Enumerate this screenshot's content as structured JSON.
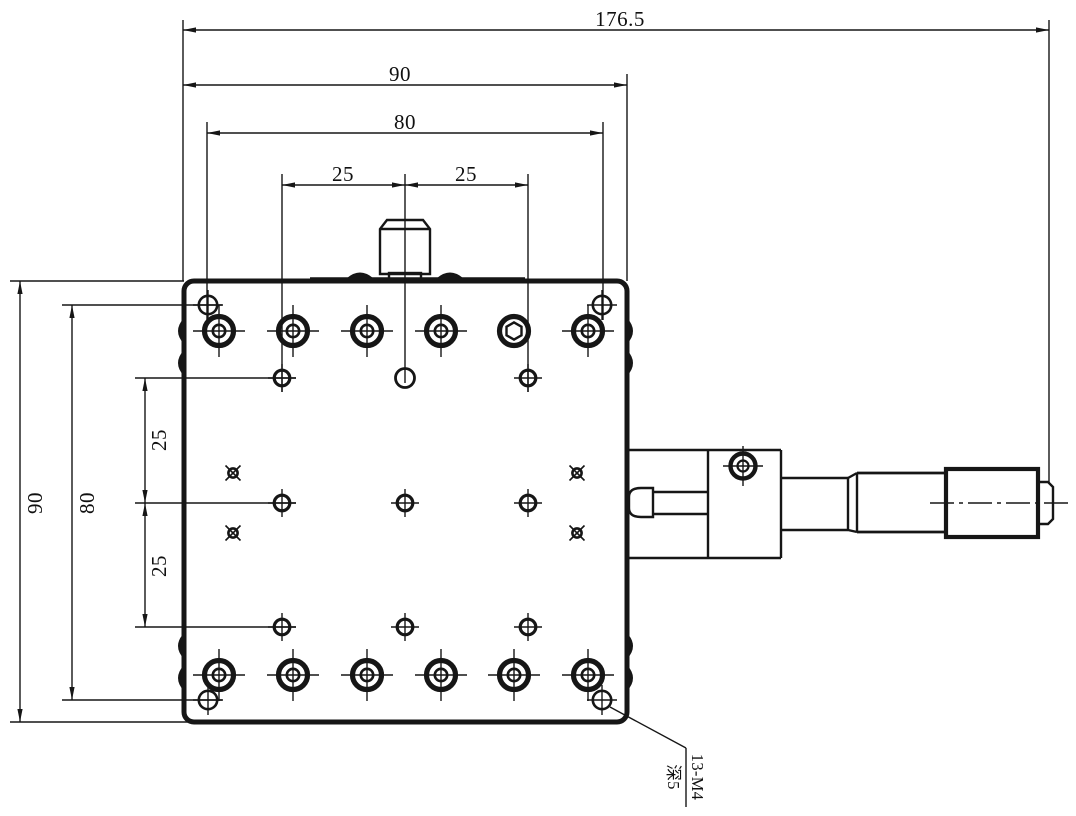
{
  "drawing": {
    "type": "engineering-dimension-drawing",
    "subject": "translation stage top view with micrometer head",
    "colors": {
      "line": "#161616",
      "background": "#ffffff"
    },
    "dims": {
      "overall_length": "176.5",
      "top_width": "90",
      "top_hole_span": "80",
      "top_pitch_left": "25",
      "top_pitch_right": "25",
      "side_height": "90",
      "side_hole_span": "80",
      "side_pitch_upper": "25",
      "side_pitch_lower": "25"
    },
    "note": {
      "line1": "13-M4",
      "line2": "深5"
    }
  }
}
